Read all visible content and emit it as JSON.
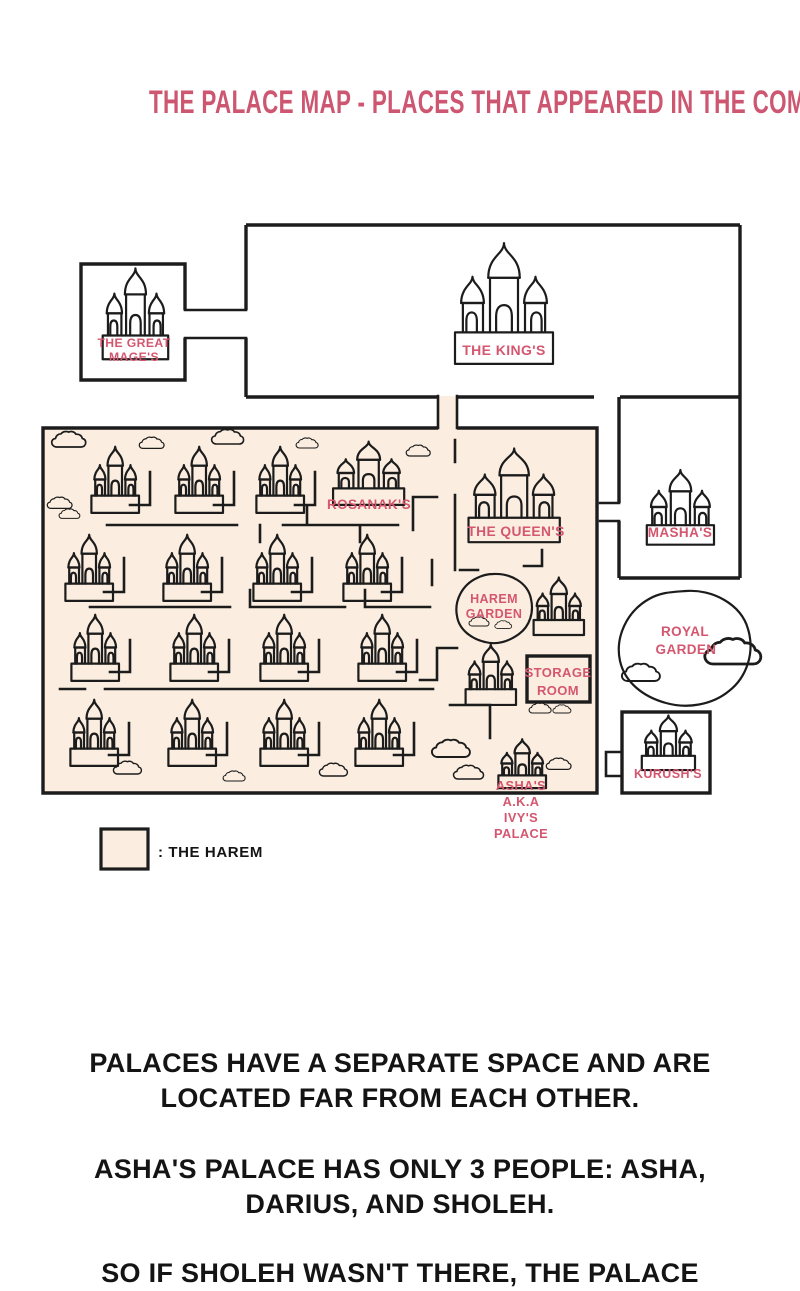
{
  "title": "THE PALACE MAP - PLACES THAT APPEARED IN THE COMICS",
  "colors": {
    "title_pink": "#cd5670",
    "label_pink": "#d4566f",
    "outline": "#1c1c1c",
    "harem_fill": "#fbeee1",
    "text_black": "#141414",
    "background": "#ffffff"
  },
  "map": {
    "rooms": {
      "great_mage": {
        "line1": "THE GREAT",
        "line2": "MAGE'S"
      },
      "king": {
        "label": "THE KING'S"
      },
      "rosanak": {
        "label": "ROSANAK'S"
      },
      "queen": {
        "label": "THE QUEEN'S"
      },
      "harem_garden": {
        "line1": "HAREM",
        "line2": "GARDEN"
      },
      "masha": {
        "label": "MASHA'S"
      },
      "royal_garden": {
        "line1": "ROYAL",
        "line2": "GARDEN"
      },
      "storage_room": {
        "line1": "STORAGE",
        "line2": "ROOM"
      },
      "kurush": {
        "label": "KURUSH'S"
      },
      "asha": {
        "line1": "ASHA'S",
        "line2": "A.K.A",
        "line3": "IVY'S",
        "line4": "PALACE"
      }
    },
    "legend": {
      "label": ": THE HAREM"
    },
    "icons": {
      "palace": "palace-icon",
      "cloud": "cloud-icon"
    }
  },
  "caption": {
    "para1": "PALACES HAVE A SEPARATE SPACE AND ARE LOCATED FAR FROM EACH OTHER.",
    "para2": "ASHA'S PALACE HAS ONLY 3 PEOPLE: ASHA, DARIUS, AND SHOLEH.",
    "para3": "SO IF SHOLEH WASN'T THERE, THE PALACE"
  }
}
